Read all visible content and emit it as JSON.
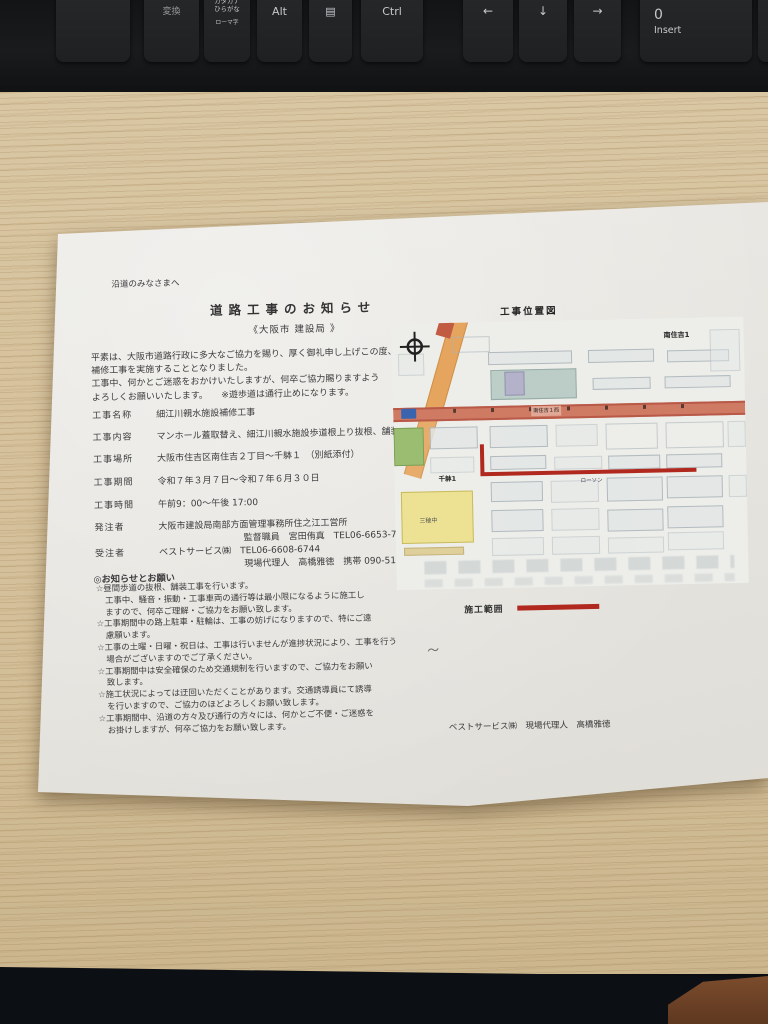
{
  "keyboard": {
    "keys": [
      {
        "label": ""
      },
      {
        "label": "変換"
      },
      {
        "label": "カタカナ\nひらがな",
        "sub": "ローマ字"
      },
      {
        "label": "Alt"
      },
      {
        "label": "▤"
      },
      {
        "label": "Ctrl"
      },
      {
        "label": "←"
      },
      {
        "label": "↓"
      },
      {
        "label": "→"
      },
      {
        "label": "0",
        "sub": "Insert"
      },
      {
        "label": ""
      }
    ]
  },
  "paper": {
    "salutation": "沿道のみなさまへ",
    "title": "道路工事のお知らせ",
    "issuer": "《大阪市 建設局 》",
    "intro_lines": [
      "平素は、大阪市道路行政に多大なご協力を賜り、厚く御礼申し上げこの度、",
      "補修工事を実施することとなりました。",
      "工事中、何かとご迷惑をおかけいたしますが、何卒ご協力賜りますよう",
      "よろしくお願いいたします。　　※遊歩道は通行止めになります。"
    ],
    "fields": [
      {
        "label": "工事名称",
        "value": "細江川親水施設補修工事"
      },
      {
        "label": "工事内容",
        "value": "マンホール蓋取替え、細江川親水施設歩道根上り抜根、舗装工事"
      },
      {
        "label": "工事場所",
        "value": "大阪市住吉区南住吉２丁目～千躰１　（別紙添付）"
      },
      {
        "label": "工事期間",
        "value": "令和７年３月７日～令和７年６月３０日"
      },
      {
        "label": "工事時間",
        "value": "午前9：00～午後 17:00"
      },
      {
        "label": "発注者",
        "value": "大阪市建設局南部方面管理事務所住之江工営所",
        "sub": "監督職員　宮田侑真　TEL06-6653-7633"
      },
      {
        "label": "受注者",
        "value": "ベストサービス㈱　TEL06-6608-6744",
        "sub": "現場代理人　高橋雅徳　携帯 090-5166-9479"
      }
    ],
    "notice": {
      "heading": "◎お知らせとお願い",
      "lines": [
        "☆昼間歩道の抜根、舗装工事を行います。",
        "工事中、騒音・振動・工事車両の通行等は最小限になるように施工し",
        "ますので、何卒ご理解・ご協力をお願い致します。",
        "☆工事期間中の路上駐車・駐輪は、工事の妨げになりますので、特にご遠",
        "慮願います。",
        "☆工事の土曜・日曜・祝日は、工事は行いませんが進捗状況により、工事を行う",
        "場合がございますのでご了承ください。",
        "☆工事期間中は安全確保のため交通規制を行いますので、ご協力をお願い",
        "致します。",
        "☆施工状況によっては迂回いただくことがあります。交通誘導員にて誘導",
        "を行いますので、ご協力のほどよろしくお願い致します。",
        "☆工事期間中、沿道の方々及び通行の方々には、何かとご不便・ご迷惑を",
        "お掛けしますが、何卒ご協力をお願い致します。"
      ]
    },
    "signature": "ベストサービス㈱　現場代理人　高橋雅徳"
  },
  "map": {
    "title": "工事位置図",
    "labels": {
      "district_top": "南住吉1",
      "district_left": "千躰1",
      "school": "三稜中",
      "store": "ローソン",
      "road": "南住吉１西"
    },
    "legend": {
      "label": "施工範囲"
    },
    "note_mark": "～",
    "colors": {
      "construction_line": "#b0281e",
      "main_road_band": "#cf7a63",
      "diagonal_road": "#e6a55e",
      "school_block": "#ede293"
    }
  }
}
